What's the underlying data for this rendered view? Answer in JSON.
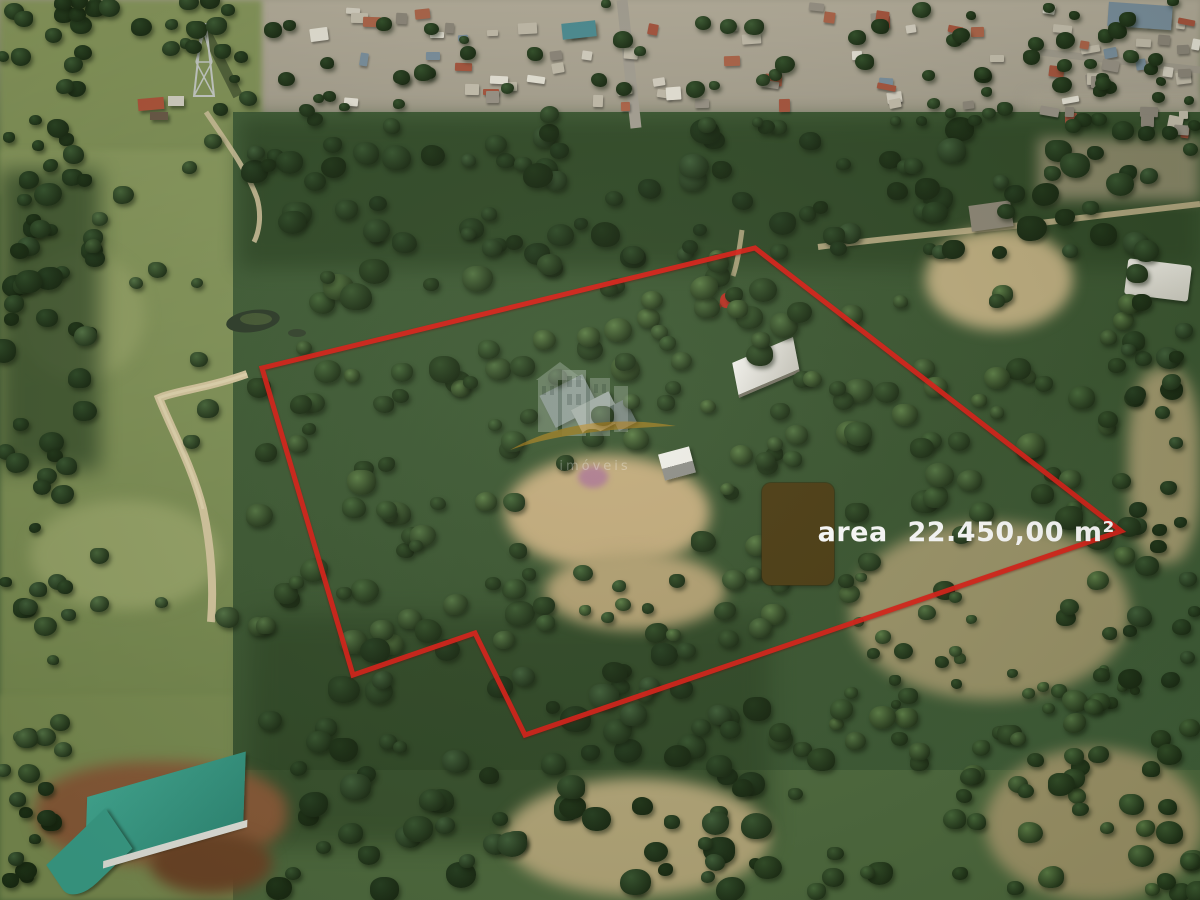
{
  "scene": {
    "description": "Aerial drone photograph of a rural land parcel outlined in red, with a residential neighborhood along the top, green pastures and a dirt road on the left, dense forest in the middle and dry clearings, small sheds and houses inside the parcel",
    "area_label": "area  22.450,00 m²",
    "boundary": {
      "color": "#dd1f17",
      "points": "262,368 755,248 1121,531 525,735 475,633 353,675"
    },
    "label_style": {
      "background": "#4d3d14",
      "text_color": "#ffffff"
    },
    "watermark": {
      "text": "imóveis",
      "swoosh_color": "#d6951c"
    }
  }
}
